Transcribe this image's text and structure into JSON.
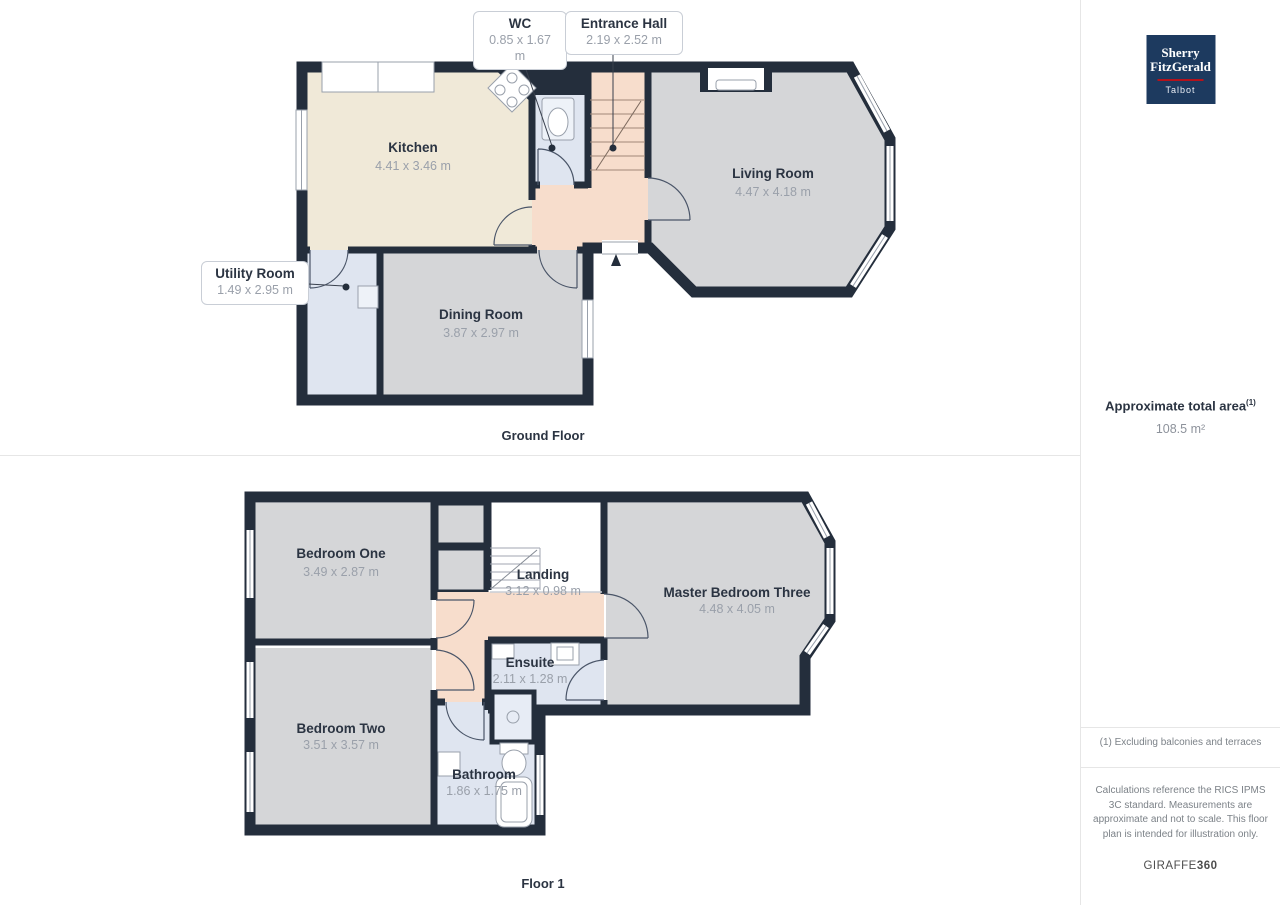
{
  "ground_floor": {
    "title": "Ground Floor",
    "rooms": {
      "kitchen": {
        "label": "Kitchen",
        "dims": "4.41 x 3.46 m"
      },
      "living_room": {
        "label": "Living Room",
        "dims": "4.47 x 4.18 m"
      },
      "dining_room": {
        "label": "Dining Room",
        "dims": "3.87 x 2.97 m"
      },
      "wc": {
        "label": "WC",
        "dims": "0.85 x 1.67 m"
      },
      "entrance_hall": {
        "label": "Entrance Hall",
        "dims": "2.19 x 2.52 m"
      },
      "utility_room": {
        "label": "Utility Room",
        "dims": "1.49 x 2.95 m"
      }
    }
  },
  "floor_1": {
    "title": "Floor 1",
    "rooms": {
      "bedroom_one": {
        "label": "Bedroom One",
        "dims": "3.49 x 2.87 m"
      },
      "landing": {
        "label": "Landing",
        "dims": "3.12 x 0.98 m"
      },
      "master_bedroom_three": {
        "label": "Master Bedroom Three",
        "dims": "4.48 x 4.05 m"
      },
      "bedroom_two": {
        "label": "Bedroom Two",
        "dims": "3.51 x 3.57 m"
      },
      "ensuite": {
        "label": "Ensuite",
        "dims": "2.11 x 1.28 m"
      },
      "bathroom": {
        "label": "Bathroom",
        "dims": "1.86 x 1.75 m"
      }
    }
  },
  "sidebar": {
    "logo": {
      "line1": "Sherry",
      "line2": "FitzGerald",
      "line3": "Talbot"
    },
    "area_title": "Approximate total area",
    "area_superscript": "(1)",
    "area_value": "108.5 m²",
    "footnote": "(1) Excluding balconies and terraces",
    "disclaimer": "Calculations reference the RICS IPMS 3C standard. Measurements are approximate and not to scale. This floor plan is intended for illustration only.",
    "brand": "GIRAFFE",
    "brand_bold": "360"
  },
  "colors": {
    "wall": "#242e3c",
    "kitchen_fill": "#f0e9d8",
    "hall_fill": "#f7ddcc",
    "gray_room_fill": "#d5d6d8",
    "wet_room_fill": "#dfe5f0",
    "logo_navy": "#1d3a5f",
    "logo_red": "#b5121b"
  }
}
